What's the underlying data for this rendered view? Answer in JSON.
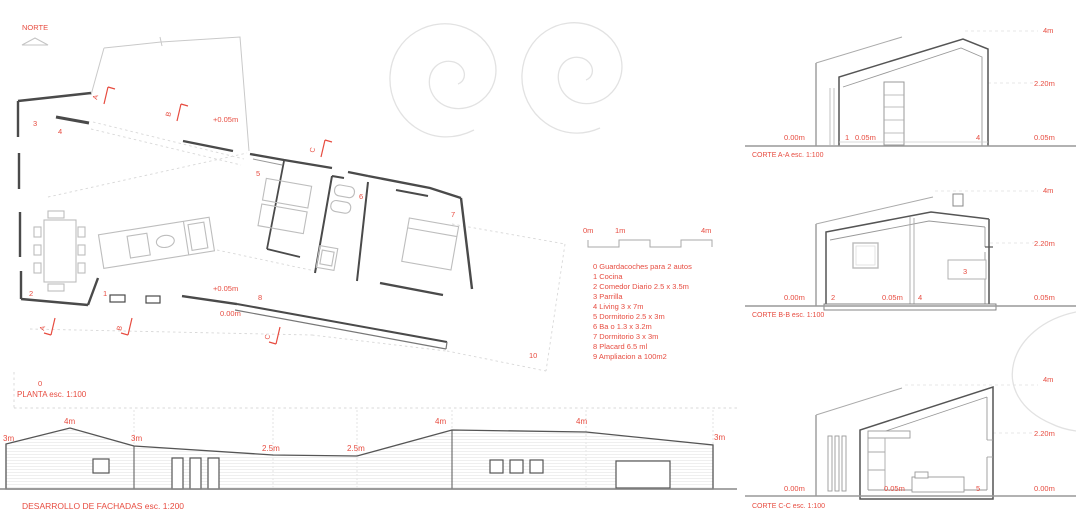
{
  "colors": {
    "accent_red": "#e74c40",
    "wall_dark": "#4a4a4a",
    "line_light": "#c9c9c9"
  },
  "plan": {
    "north_label": "NORTE",
    "title": "PLANTA esc. 1:100",
    "room_label_0": "0",
    "levels": {
      "upper": "+0.05m",
      "lower": "+0.05m",
      "ground": "0.00m"
    },
    "rooms": {
      "r1": "1",
      "r2": "2",
      "r3": "3",
      "r4": "4",
      "r5": "5",
      "r6": "6",
      "r7": "7",
      "r8": "8",
      "r10": "10"
    },
    "markers": {
      "a": "A",
      "b": "B",
      "c": "C"
    }
  },
  "legend": {
    "items": [
      "0 Guardacoches para 2 autos",
      "1 Cocina",
      "2 Comedor Diario 2.5 x 3.5m",
      "3 Parrilla",
      "4 Living 3 x 7m",
      "5 Dormitorio 2.5 x 3m",
      "6 Ba o 1.3 x 3.2m",
      "7 Dormitorio 3 x 3m",
      "8 Placard 6.5 ml",
      "9 Ampliacion a 100m2"
    ]
  },
  "scalebar": {
    "start": "0m",
    "mid": "1m",
    "end": "4m"
  },
  "elevation": {
    "title": "DESARROLLO DE FACHADAS esc. 1:200",
    "heights": [
      "3m",
      "4m",
      "3m",
      "2.5m",
      "2.5m",
      "4m",
      "4m",
      "3m"
    ]
  },
  "sections": {
    "a": {
      "title": "CORTE A-A esc. 1:100",
      "h_top": "4m",
      "h_mid": "2.20m",
      "left": "0.00m",
      "num1": "1",
      "lvl1": "0.05m",
      "num2": "4",
      "right": "0.05m"
    },
    "b": {
      "title": "CORTE B-B esc. 1:100",
      "h_top": "4m",
      "h_mid": "2.20m",
      "left": "0.00m",
      "num1": "2",
      "lvl1": "0.05m",
      "num2": "4",
      "box": "3",
      "right": "0.05m"
    },
    "c": {
      "title": "CORTE C-C esc. 1:100",
      "h_top": "4m",
      "h_mid": "2.20m",
      "left": "0.00m",
      "lvl1": "0.05m",
      "num2": "5",
      "right": "0.00m"
    }
  }
}
